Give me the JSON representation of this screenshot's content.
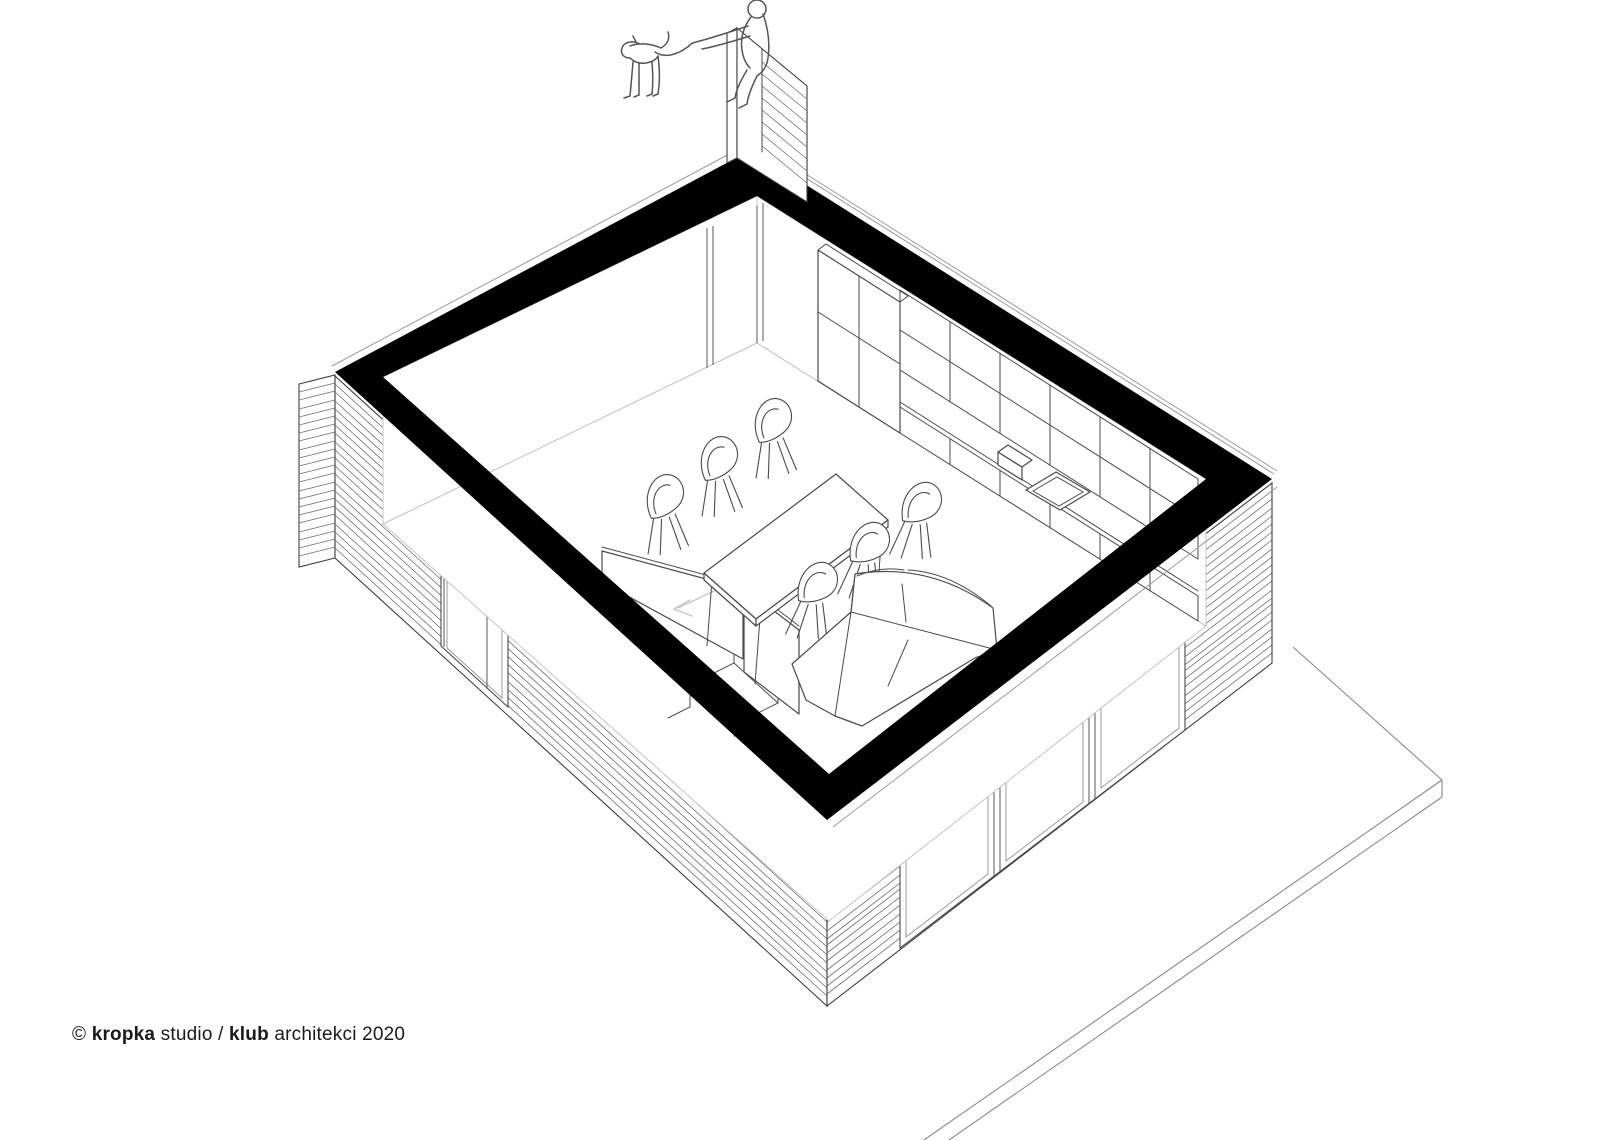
{
  "page": {
    "background": "#ffffff"
  },
  "credit": {
    "prefix": "© ",
    "studio_bold": "kropka",
    "middle": " studio / ",
    "club_bold": "klub",
    "suffix": " architekci 2020"
  },
  "drawing": {
    "type": "axonometric cutaway section",
    "subject": "single-storey timber house - open plan living room with kitchen, dining table, sofa and stair to lower level",
    "colors": {
      "cut_poche": "#000000",
      "wall_line": "#3c3c3c",
      "furniture_line": "#4a4a4a",
      "through_glass_line": "#c8c8c8",
      "siding_line": "#6f6f6f",
      "background": "#ffffff"
    },
    "elements": [
      "cut-wall-band",
      "wood-siding-facade",
      "facade-window",
      "glazed-sliding-doors",
      "kitchen-tall-cabinet",
      "kitchen-upper-cabinets",
      "kitchen-counter",
      "kitchen-sink",
      "dining-table",
      "dining-chairs",
      "corner-sofa",
      "staircase",
      "stair-balustrade",
      "direction-arrow",
      "terrace-deck",
      "chimney-wall-fragment",
      "person-figure",
      "dog-figure",
      "side-stool",
      "armchair"
    ]
  }
}
